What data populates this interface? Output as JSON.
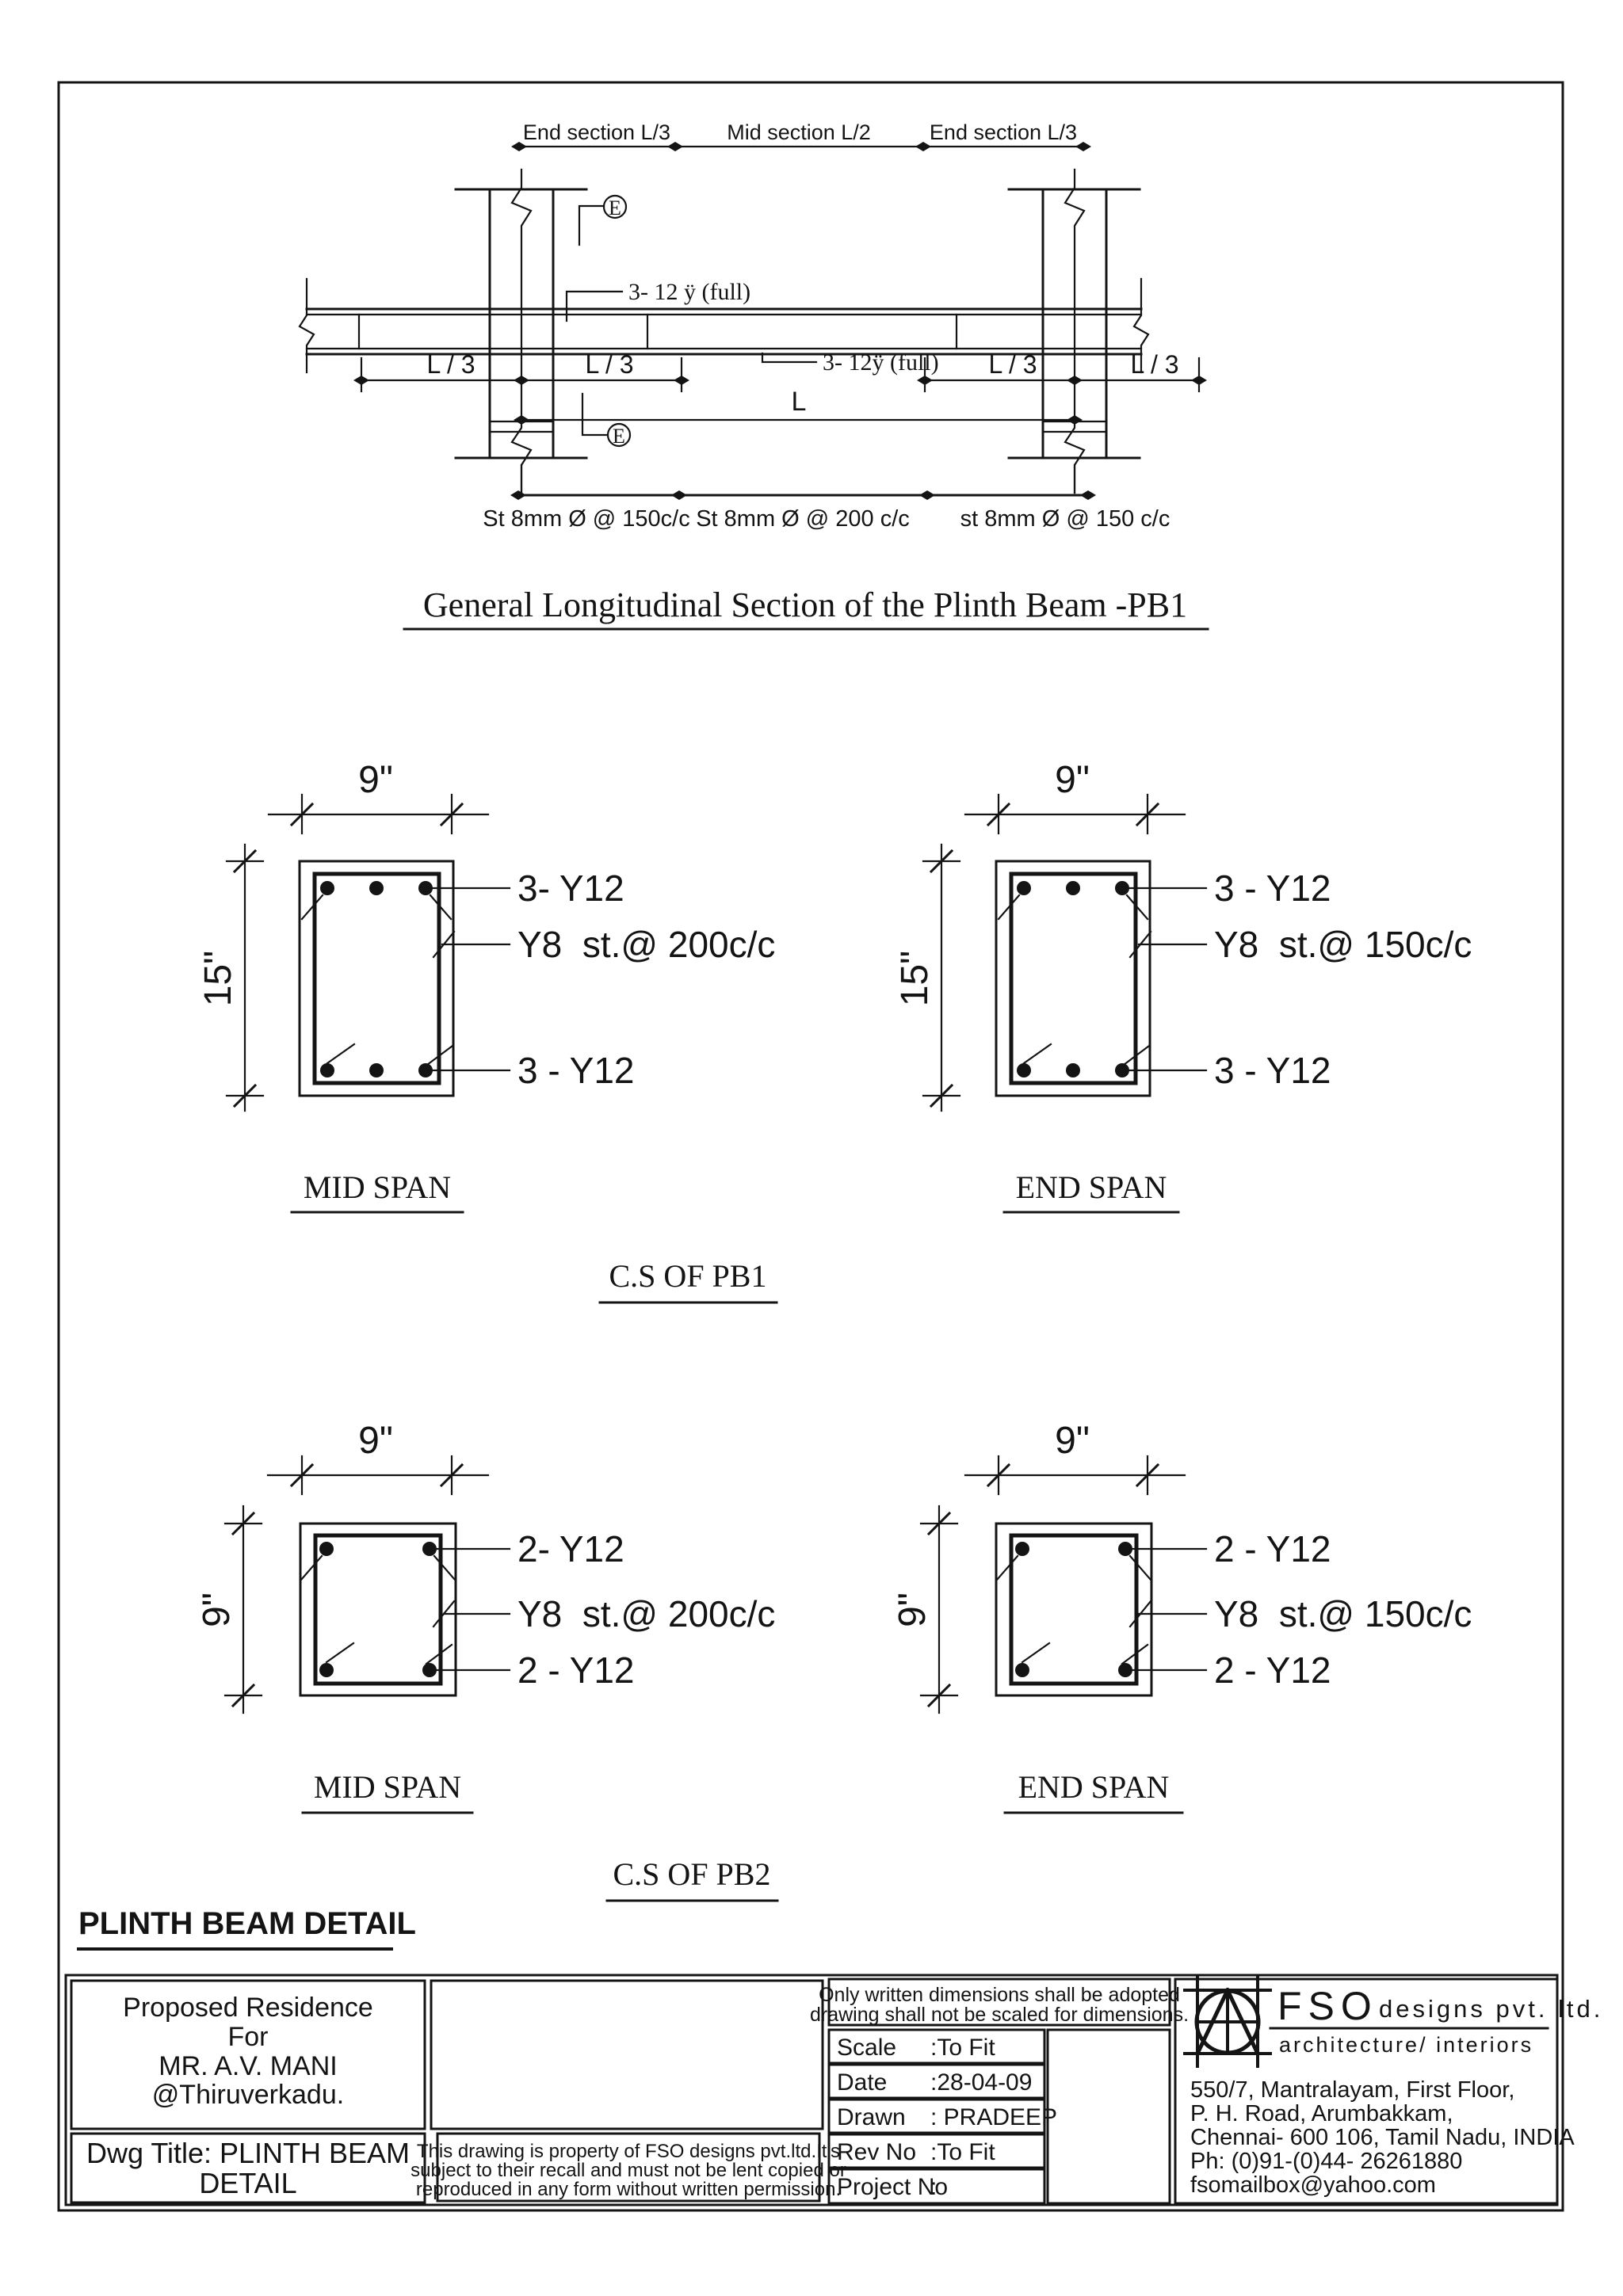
{
  "sheet": {
    "background": "#ffffff",
    "ink": "#141414"
  },
  "longitudinal": {
    "title": "General Longitudinal Section of the Plinth Beam -PB1",
    "top_dims": [
      "End section L/3",
      "Mid section L/2",
      "End section L/3"
    ],
    "top_bar_label": "3- 12 ÿ (full)",
    "bottom_bar_label": "3- 12ÿ (full)",
    "span_labels": [
      "L / 3",
      "L / 3",
      "L / 3",
      "L / 3"
    ],
    "total_span_label": "L",
    "stirrup_zones": [
      "St 8mm Ø @ 150c/c",
      "St 8mm Ø @ 200 c/c",
      "st 8mm Ø @ 150 c/c"
    ],
    "end_marker": "E"
  },
  "cs_pb1": {
    "caption": "C.S OF PB1",
    "mid": {
      "name": "MID SPAN",
      "width_dim": "9\"",
      "height_dim": "15\"",
      "top_bars": "3- Y12",
      "stirrups": "Y8  st.@ 200c/c",
      "bottom_bars": "3 - Y12"
    },
    "end": {
      "name": "END SPAN",
      "width_dim": "9\"",
      "height_dim": "15\"",
      "top_bars": "3 - Y12",
      "stirrups": "Y8  st.@ 150c/c",
      "bottom_bars": "3 - Y12"
    }
  },
  "cs_pb2": {
    "caption": "C.S OF PB2",
    "mid": {
      "name": "MID SPAN",
      "width_dim": "9\"",
      "height_dim": "9\"",
      "top_bars": "2- Y12",
      "stirrups": "Y8  st.@ 200c/c",
      "bottom_bars": "2 - Y12"
    },
    "end": {
      "name": "END SPAN",
      "width_dim": "9\"",
      "height_dim": "9\"",
      "top_bars": "2 - Y12",
      "stirrups": "Y8  st.@ 150c/c",
      "bottom_bars": "2 - Y12"
    }
  },
  "heading": "PLINTH BEAM DETAIL",
  "title_block": {
    "project_lines": [
      "Proposed Residence",
      "For",
      "MR. A.V. MANI",
      "@Thiruverkadu."
    ],
    "dwg_title_lines": [
      "Dwg Title: PLINTH BEAM",
      "DETAIL"
    ],
    "property_note_lines": [
      "This drawing is property of FSO designs pvt.ltd.It's",
      "subject  to their recall and must not be lent copied or",
      "reproduced in any form without written permission."
    ],
    "dimension_note_lines": [
      "Only written dimensions shall be adopted",
      "drawing  shall not be scaled for dimensions."
    ],
    "fields": [
      {
        "label": "Scale",
        "value": ":To Fit"
      },
      {
        "label": "Date",
        "value": ":28-04-09"
      },
      {
        "label": "Drawn",
        "value": ": PRADEEP"
      },
      {
        "label": "Rev No",
        "value": ":To Fit"
      },
      {
        "label": "Project No",
        "value": ":"
      }
    ],
    "firm": {
      "name": "FSO",
      "type": "designs pvt. ltd.",
      "tagline": "architecture/ interiors",
      "address_lines": [
        "550/7, Mantralayam, First Floor,",
        "P. H. Road, Arumbakkam,",
        "Chennai- 600 106, Tamil Nadu, INDIA",
        "Ph: (0)91-(0)44- 26261880",
        "fsomailbox@yahoo.com"
      ]
    }
  }
}
